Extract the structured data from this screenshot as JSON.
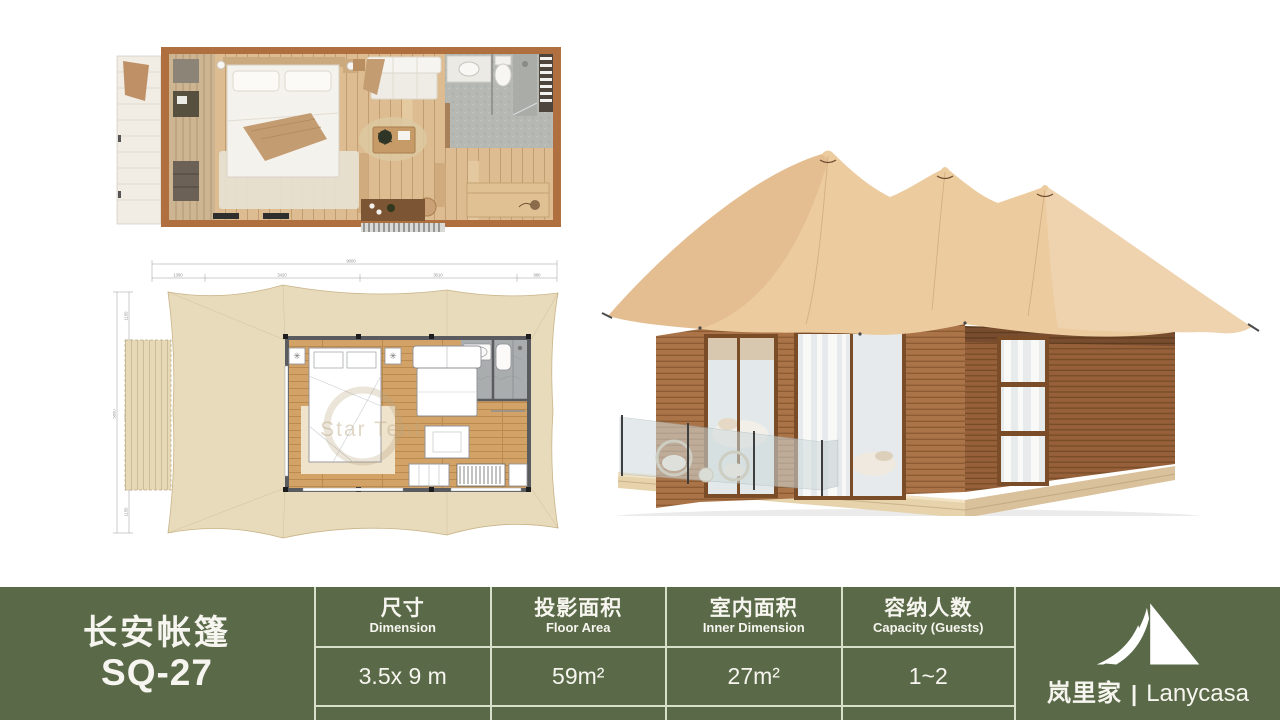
{
  "product": {
    "name_zh": "长安帐篷",
    "model": "SQ-27"
  },
  "spec_table": {
    "columns": [
      {
        "label_zh": "尺寸",
        "label_en": "Dimension",
        "value": "3.5x 9 m"
      },
      {
        "label_zh": "投影面积",
        "label_en": "Floor Area",
        "value": "59m²"
      },
      {
        "label_zh": "室内面积",
        "label_en": "Inner Dimension",
        "value": "27m²"
      },
      {
        "label_zh": "容纳人数",
        "label_en": "Capacity (Guests)",
        "value": "1~2"
      }
    ]
  },
  "brand": {
    "icon": "tent-icon",
    "name_zh": "岚里家",
    "separator": "|",
    "name_en": "Lanycasa"
  },
  "drawing": {
    "watermark": "Star Tent",
    "dimensions": {
      "total_width": "9000",
      "seg1": "1390",
      "seg2": "3420",
      "seg3": "3010",
      "seg4": "980",
      "left_total": "5800",
      "left_top": "1150",
      "left_mid": "3500",
      "left_bottom": "1150"
    }
  },
  "colors": {
    "band_green": "#5a6a48",
    "table_border": "#d9e0ca",
    "canvas_tan": "#eccb9f",
    "wood_brown": "#aa7448",
    "drawing_beige": "#e8dbbb",
    "floor_wood": "#d2a267"
  }
}
